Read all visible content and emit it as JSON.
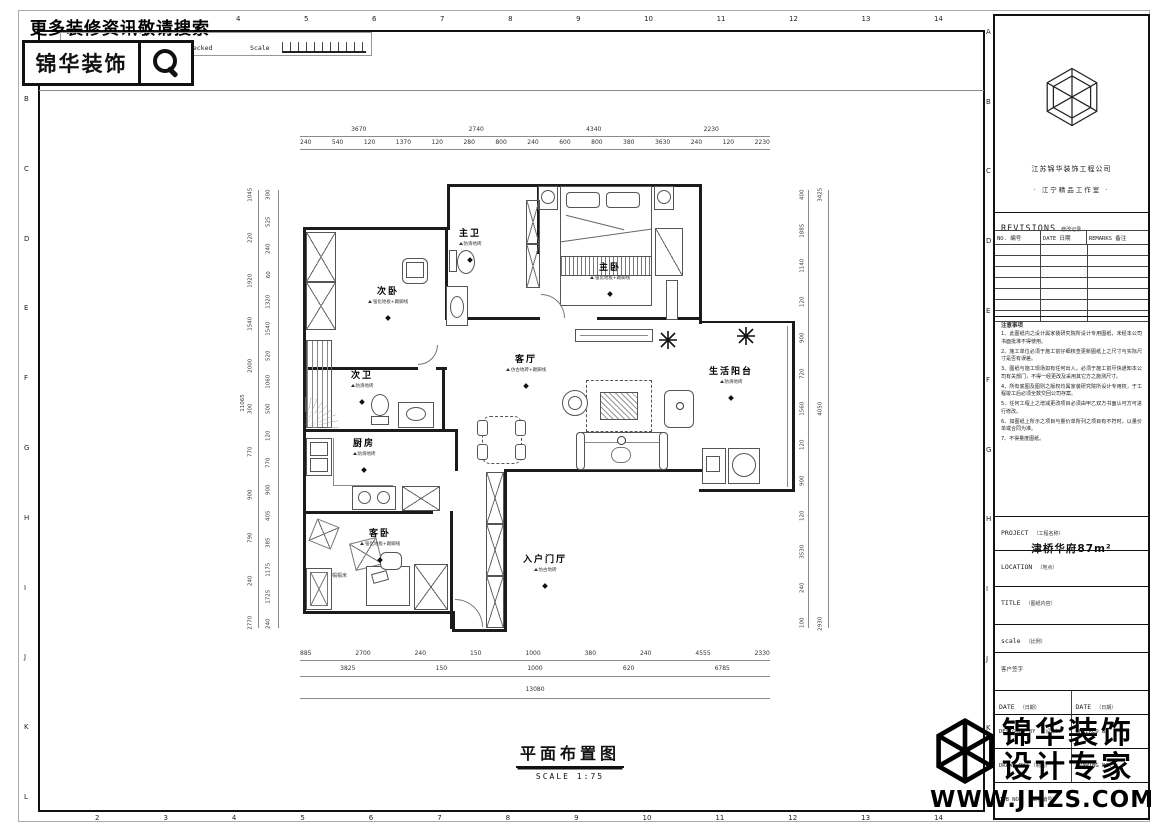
{
  "banner": {
    "search_text": "更多装修资讯敬请搜索",
    "logo_text": "锦华装饰"
  },
  "header_bar": {
    "signature": "Signature",
    "checked": "Checked",
    "scale_label": "Scale"
  },
  "grid": {
    "top_numbers": [
      "4",
      "5",
      "6",
      "7",
      "8",
      "9",
      "10",
      "11",
      "12",
      "13",
      "14"
    ],
    "bottom_numbers": [
      "2",
      "3",
      "4",
      "5",
      "6",
      "7",
      "8",
      "9",
      "10",
      "11",
      "12",
      "13",
      "14"
    ],
    "left_letters": [
      "B",
      "C",
      "D",
      "E",
      "F",
      "G",
      "H",
      "I",
      "J",
      "K",
      "L"
    ],
    "right_letters": [
      "A",
      "B",
      "C",
      "D",
      "E",
      "F",
      "G",
      "H",
      "I",
      "J",
      "K",
      "L"
    ]
  },
  "plan": {
    "title": "平面布置图",
    "scale_note": "SCALE  1:75",
    "tatami_label": "榻榻米",
    "rooms": [
      {
        "name": "主卫",
        "finish": "防滑地砖"
      },
      {
        "name": "主卧",
        "finish": "强化地板+踢脚线"
      },
      {
        "name": "次卧",
        "finish": "强化地板+踢脚线"
      },
      {
        "name": "次卫",
        "finish": "防滑地砖"
      },
      {
        "name": "厨房",
        "finish": "防滑地砖"
      },
      {
        "name": "客厅",
        "finish": "仿古地砖+踢脚线"
      },
      {
        "name": "生活阳台",
        "finish": "防滑地砖"
      },
      {
        "name": "客卧",
        "finish": "强化地板+踢脚线"
      },
      {
        "name": "入户门厅",
        "finish": "仿古地砖"
      }
    ],
    "dims": {
      "top_row1": [
        "3670",
        "2740",
        "4340",
        "2230"
      ],
      "top_row2": [
        "240",
        "540",
        "120",
        "1370",
        "120",
        "280",
        "800",
        "240",
        "600",
        "800",
        "380",
        "3630",
        "240",
        "120",
        "2230"
      ],
      "bottom_row1": [
        "885",
        "2700",
        "240",
        "150",
        "1000",
        "380",
        "240",
        "4555",
        "2330"
      ],
      "bottom_row2": [
        "3825",
        "150",
        "1000",
        "620",
        "6785"
      ],
      "bottom_total": "13080",
      "left_inner": [
        "300",
        "525",
        "240",
        "60",
        "1320",
        "1540",
        "520",
        "1060",
        "500",
        "120",
        "770",
        "900",
        "405",
        "385",
        "1175",
        "1725",
        "240"
      ],
      "left_outer": [
        "1045",
        "220",
        "1920",
        "1540",
        "2000",
        "300",
        "770",
        "900",
        "790",
        "240",
        "2770"
      ],
      "left_total": "11065",
      "right_inner": [
        "400",
        "1885",
        "1140",
        "120",
        "900",
        "720",
        "1560",
        "120",
        "900",
        "120",
        "3530",
        "240",
        "100"
      ],
      "right_outer": [
        "3425",
        "4050",
        "2930"
      ]
    }
  },
  "titleblock": {
    "company_line1": "江苏锦华装饰工程公司",
    "company_line2": "· 江宁精品工作室 ·",
    "revisions": {
      "title": "REVISIONS",
      "title_cn": "修改记录",
      "col_no": "NO. 编号",
      "col_date": "DATE 日期",
      "col_remarks": "REMARKS 备注",
      "rows": [
        "",
        "",
        "",
        "",
        "",
        "",
        ""
      ]
    },
    "notes": {
      "title": "注意事项",
      "items": [
        "1、此图纸内之设计属家装研究院所设计专用图纸，未经本公司书面批准不得使用。",
        "2、施工单位必须于施工前仔细核查更新图纸上之尺寸与实际尺寸是否有误差。",
        "3、图纸与施工现场如有任何出入，必须于施工前尽快通知本公司有关部门，不得一经更改及采用其它方之施测尺寸。",
        "4、所有底图及图则之版权均属家装研究院所设计专用权，于工程竣工后必须全数交回公司存案。",
        "5、任何工程上之增减更改项目必须由甲乙双方书面认可方可进行修改。",
        "6、如图纸上所示之项目与量价单所列之项目有不符时，以量价单或合同为准。",
        "7、不得量度图纸。"
      ]
    },
    "project": {
      "label": "PROJECT",
      "label_cn": "（工程名称）",
      "value": "津桥华府87m²"
    },
    "location": {
      "label": "LOCATION",
      "label_cn": "（地点）",
      "value": ""
    },
    "title_field": {
      "label": "TITLE",
      "label_cn": "（图纸内容）",
      "value": ""
    },
    "scale_field": {
      "label": "scale",
      "label_cn": "（比例）",
      "value": ""
    },
    "client_sign": "客户签字",
    "date_left": {
      "label": "DATE",
      "label_cn": "（日期）"
    },
    "date_right": {
      "label": "DATE",
      "label_cn": "（日期）"
    },
    "designed_by": {
      "label": "DESIGNED BY",
      "label_cn": "（设计）"
    },
    "checked_by": {
      "label": "CHECKED BY",
      "label_cn": ""
    },
    "drawn_by": {
      "label": "DRAWN BY",
      "label_cn": "（制图）"
    },
    "drawing_no": {
      "label": "DRAWING NO.",
      "label_cn": ""
    },
    "job_no": {
      "label": "JOB NO.",
      "label_cn": "（工程编号）"
    }
  },
  "watermark": {
    "line1": "锦华装饰",
    "line2": "设计专家",
    "url": "WWW.JHZS.COM"
  }
}
